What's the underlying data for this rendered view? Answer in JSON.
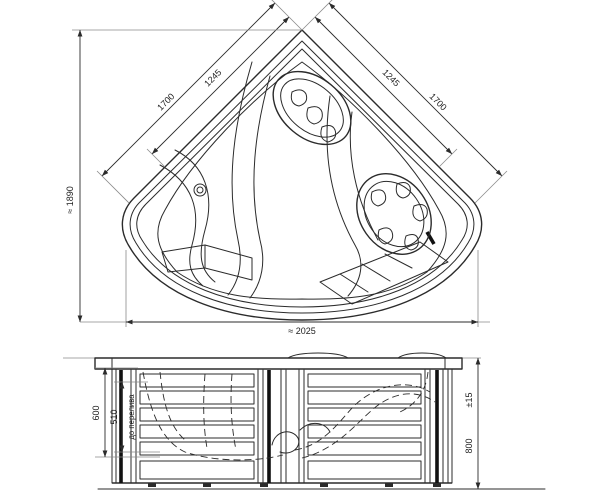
{
  "colors": {
    "line": "#2b2b2b",
    "background": "#ffffff"
  },
  "top_view": {
    "side_left_outer": "1700",
    "side_left_inner": "1245",
    "side_right_inner": "1245",
    "side_right_outer": "1700",
    "overall_height": "≈ 1890",
    "overall_width": "≈ 2025"
  },
  "front_view": {
    "depth_total": "600",
    "depth_to_overflow": "510",
    "overflow_note": "до перелива",
    "height_value": "800",
    "height_tolerance": "±15"
  }
}
